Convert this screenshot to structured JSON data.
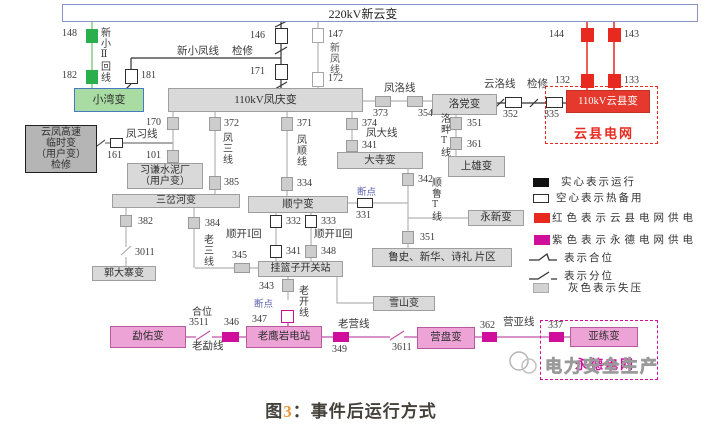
{
  "colors": {
    "bus_border": "#8a93c8",
    "gray_fill": "#d9d9d9",
    "gray_border": "#9e9e9e",
    "gray_line": "#b3b3b3",
    "dark_fill": "#b5b5b5",
    "green": "#2ab04b",
    "green_line": "#a8d7a3",
    "green_box": "#a9dca3",
    "green_box_border": "#4a79c4",
    "red": "#e8291f",
    "red_box": "#e4392c",
    "magenta": "#cf0f9b",
    "magenta_box": "#eda3d6",
    "magenta_border": "#b9599f",
    "magenta_line": "#c155a8",
    "break_label": "#5a5fae",
    "caption_num": "#e8973c"
  },
  "bus": {
    "label": "220kV新云变"
  },
  "substations": {
    "xiaowan": "小湾变",
    "fengqing": "110kV凤庆变",
    "yunfeng_temp": "云凤高速\n临时变\n（用户变）\n检修",
    "xiqian": "习谦水泥厂\n（用户变）",
    "sanchahe": "三岔河变",
    "guodazhai": "郭大寨变",
    "shunning": "顺宁变",
    "dasi": "大寺变",
    "luodang": "洛党变",
    "shangxiong": "上雄变",
    "yongxin": "永新变",
    "lushi": "鲁史、新华、诗礼 片区",
    "gualanzi": "挂篮子开关站",
    "xueshan": "雪山变",
    "yunxian": "110kV云县变",
    "mengyou": "勐佑变",
    "laoyingyan": "老鹰岩电站",
    "yingpan": "营盘变",
    "yalian": "亚练变"
  },
  "regions": {
    "yunxian": "云县电网",
    "yongde": "永德电网"
  },
  "lines": {
    "xinxiao2": "新小Ⅱ回线",
    "xinxiaofeng": "新小凤线",
    "xinfeng": "新凤线",
    "fengluo": "凤洛线",
    "yunluo": "云洛线",
    "fengxi": "凤习线",
    "fengsan": "凤三线",
    "fengshun": "凤顺线",
    "fengda": "凤大线",
    "luopan_t": "洛畔T线",
    "shunlu_t": "顺鲁T线",
    "laosan": "老三线",
    "shunkai1": "顺开Ⅰ回",
    "shunkai2": "顺开Ⅱ回",
    "laokai": "老开线",
    "laomeng": "老勐线",
    "laoying": "老营线",
    "yingya": "营亚线"
  },
  "nums": {
    "n148": "148",
    "n182": "182",
    "n181": "181",
    "n146": "146",
    "n171": "171",
    "n147": "147",
    "n172": "172",
    "n144": "144",
    "n143": "143",
    "n132": "132",
    "n133": "133",
    "n170": "170",
    "n101": "101",
    "n161": "161",
    "n372": "372",
    "n385": "385",
    "n371": "371",
    "n334": "334",
    "n374": "374",
    "n341a": "341",
    "n373": "373",
    "n354": "354",
    "n352": "352",
    "n335": "335",
    "n351a": "351",
    "n361": "361",
    "n342": "342",
    "n351b": "351",
    "n331": "331",
    "n332": "332",
    "n341b": "341",
    "n333": "333",
    "n348": "348",
    "n345": "345",
    "n384": "384",
    "n382": "382",
    "n3011": "3011",
    "n343": "343",
    "n347": "347",
    "n346": "346",
    "n3511": "3511",
    "n349": "349",
    "n3611": "3611",
    "n362": "362",
    "n337": "337"
  },
  "annotations": {
    "jianxiu": "检修",
    "duandian": "断点",
    "hewei": "合位"
  },
  "legend": {
    "l1": "实心表示运行",
    "l2": "空心表示热备用",
    "l3": "红色表示云县电网供电",
    "l4": "紫色表示永德电网供电",
    "l5": "表示合位",
    "l6": "表示分位",
    "l7": "灰色表示失压"
  },
  "watermark": {
    "text": "电力安全生产"
  },
  "caption": {
    "fig": "图",
    "num": "3",
    "rest": "：事件后运行方式"
  }
}
